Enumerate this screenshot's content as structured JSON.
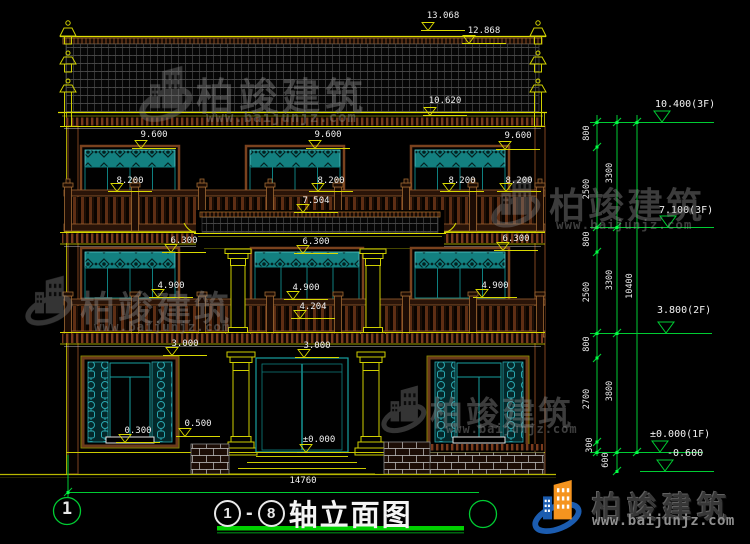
{
  "drawing": {
    "title": {
      "axis_start": "1",
      "separator": "-",
      "axis_end": "8",
      "name": "轴立面图"
    },
    "axis_bubble_left": "1",
    "overall_width_dim": "14760",
    "dims": {
      "d13068": "13.068",
      "d12868": "12.868",
      "d10620": "10.620",
      "d9600": "9.600",
      "d8200": "8.200",
      "d7504": "7.504",
      "d6300": "6.300",
      "d4900": "4.900",
      "d4204": "4.204",
      "d3000": "3.000",
      "d0300": "0.300",
      "d0500": "0.500",
      "dzero": "±0.000"
    },
    "levels": {
      "f3_top": "10.400(3F)",
      "f3": "7.100(3F)",
      "f2": "3.800(2F)",
      "f1": "±0.000(1F)",
      "ground": "-0.600"
    },
    "chain": {
      "seg800": "800",
      "seg2500": "2500",
      "seg2700": "2700",
      "seg300": "300",
      "seg600": "600",
      "seg3300": "3300",
      "seg3800": "3800",
      "total": "10400"
    }
  },
  "brand": {
    "name": "柏竣建筑",
    "url": "www.baijunjz.com"
  },
  "watermark": {
    "name": "柏竣建筑",
    "url": "www.baijunjz.com"
  },
  "colors": {
    "line_yellow": "#d9d900",
    "line_green": "#00cc33",
    "teal": "#17a0a0",
    "brown": "#8a4a22",
    "brand_blue": "#1b5cb0",
    "brand_orange": "#f5941f"
  }
}
